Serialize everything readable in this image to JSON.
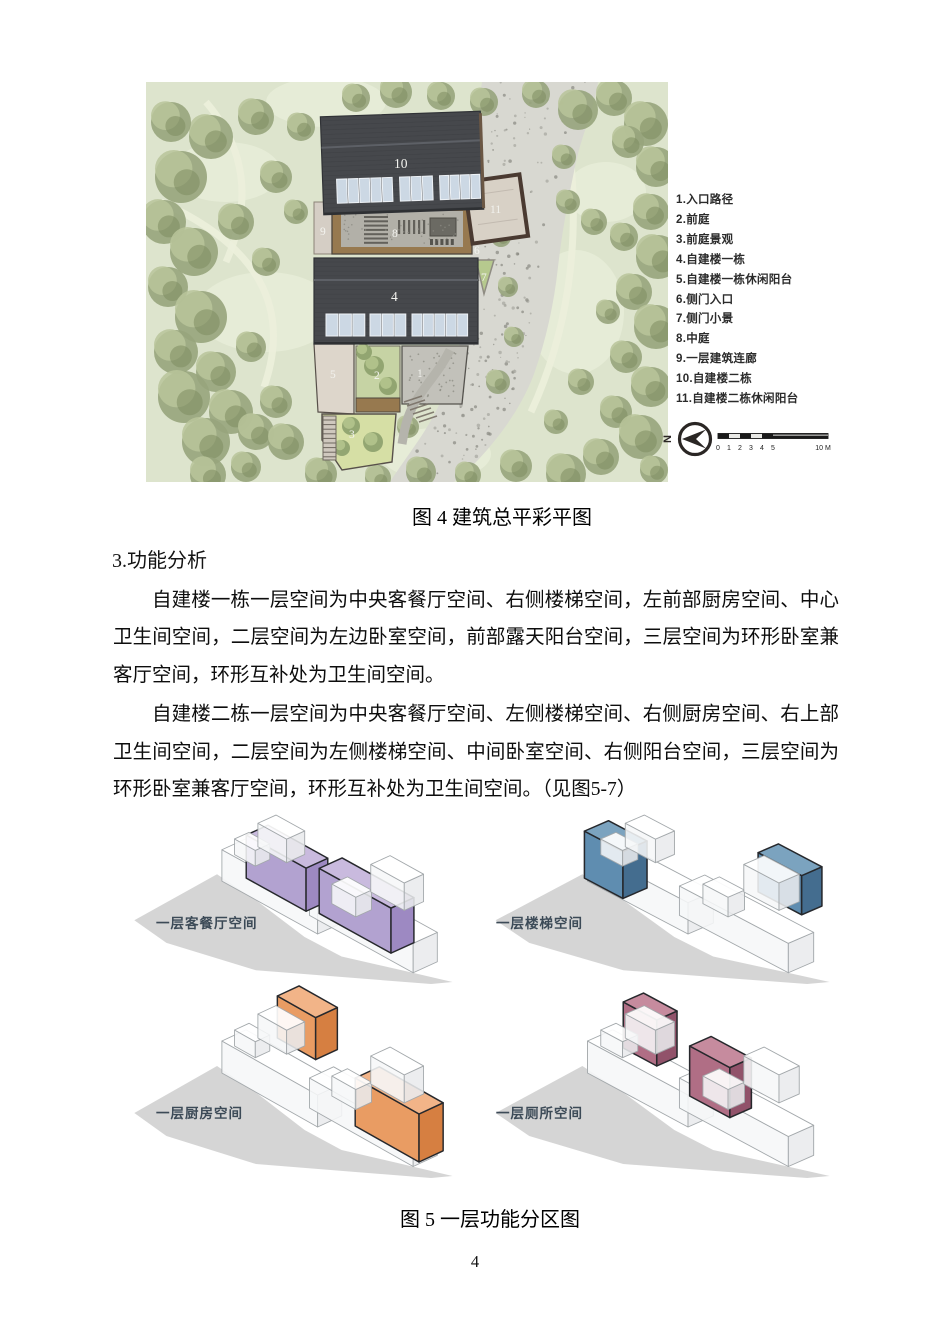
{
  "page": {
    "number": "4"
  },
  "figure4": {
    "caption": "图 4  建筑总平彩平图",
    "legend": [
      "1.入口路径",
      "2.前庭",
      "3.前庭景观",
      "4.自建楼一栋",
      "5.自建楼一栋休闲阳台",
      "6.侧门入口",
      "7.侧门小景",
      "8.中庭",
      "9.一层建筑连廊",
      "10.自建楼二栋",
      "11.自建楼二栋休闲阳台"
    ],
    "plan_labels": [
      "1",
      "2",
      "3",
      "4",
      "5",
      "6",
      "7",
      "8",
      "9",
      "10",
      "11"
    ],
    "north_label": "N",
    "scale": {
      "ticks": [
        "0",
        "1",
        "2",
        "3",
        "4",
        "5"
      ],
      "end": "10 M"
    },
    "colors": {
      "meadow": "#dde4cd",
      "tree": "#97a47c",
      "path": "#d8d8d1",
      "roof": "#46484c",
      "skylight": "#ccd8e4",
      "deck": "#97794f",
      "terrace": "#d8d1c6"
    }
  },
  "section": {
    "heading": "3.功能分析",
    "paragraphs": [
      "自建楼一栋一层空间为中央客餐厅空间、右侧楼梯空间，左前部厨房空间、中心卫生间空间，二层空间为左边卧室空间，前部露天阳台空间，三层空间为环形卧室兼客厅空间，环形互补处为卫生间空间。",
      "自建楼二栋一层空间为中央客餐厅空间、左侧楼梯空间、右侧厨房空间、右上部卫生间空间，二层空间为左侧楼梯空间、中间卧室空间、右侧阳台空间，三层空间为环形卧室兼客厅空间，环形互补处为卫生间空间。（见图5-7）"
    ]
  },
  "figure5": {
    "caption": "图 5  一层功能分区图",
    "label_color": "#3c4a57",
    "panels": [
      {
        "label": "一层客餐厅空间",
        "color_top": "#c9bade",
        "color_front": "#b2a2d0",
        "color_side": "#9d89c2"
      },
      {
        "label": "一层楼梯空间",
        "color_top": "#7ba3bf",
        "color_front": "#5f8db0",
        "color_side": "#446d8f"
      },
      {
        "label": "一层厨房空间",
        "color_top": "#f2b488",
        "color_front": "#e99c63",
        "color_side": "#d67f41"
      },
      {
        "label": "一层厕所空间",
        "color_top": "#c68b9e",
        "color_front": "#b06e85",
        "color_side": "#91526a"
      }
    ]
  }
}
